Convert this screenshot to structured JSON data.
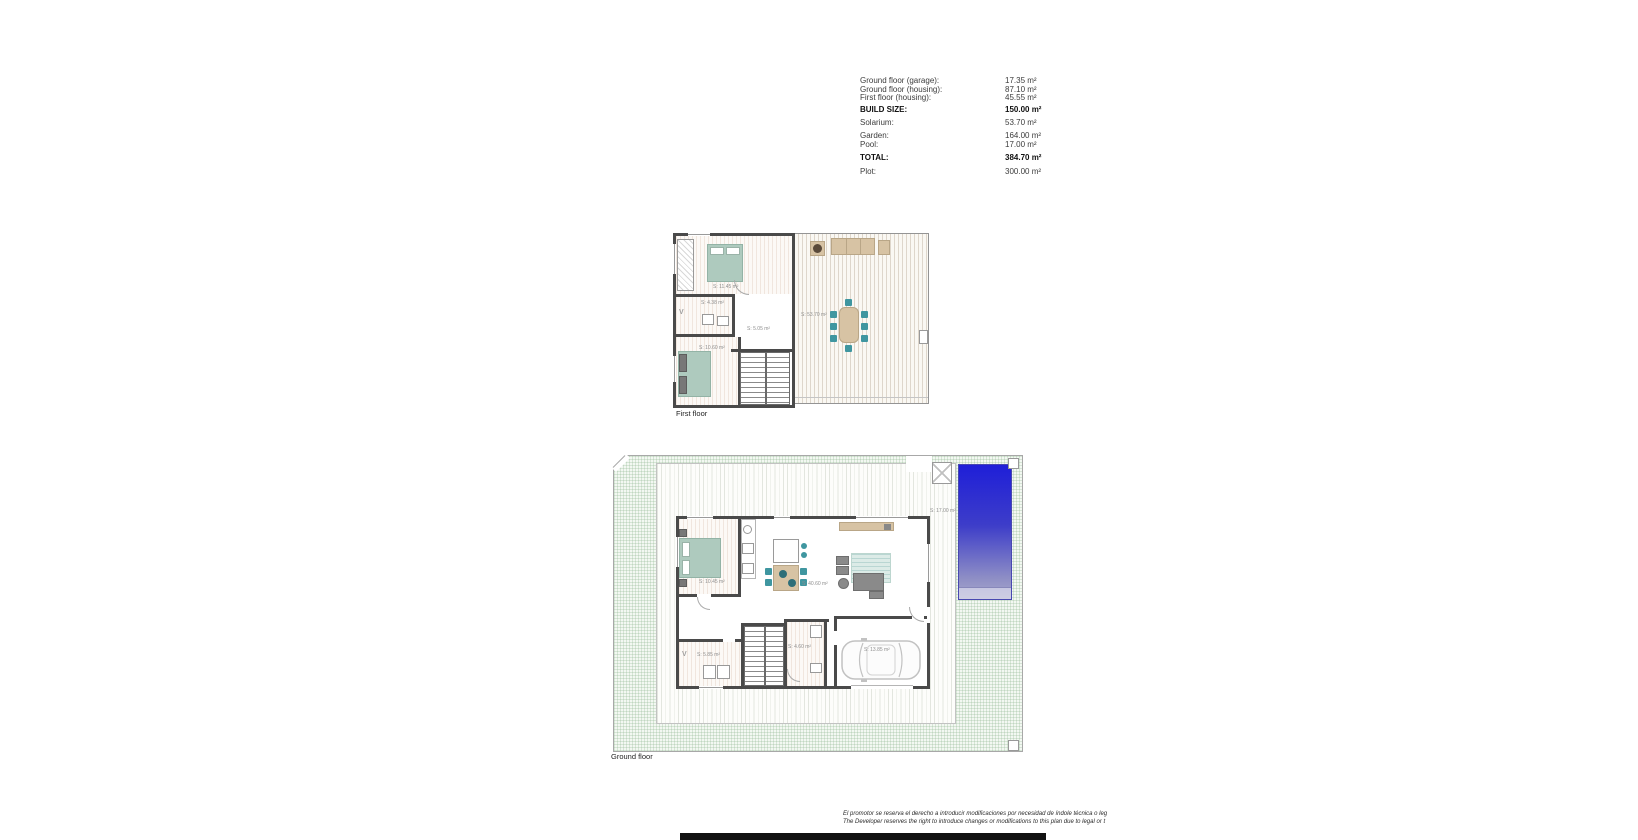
{
  "area_table": {
    "rows": [
      {
        "label": "Ground floor (garage):",
        "value": "17.35 m²"
      },
      {
        "label": "Ground floor (housing):",
        "value": "87.10 m²"
      },
      {
        "label": "First floor (housing):",
        "value": "45.55 m²"
      },
      {
        "label": "BUILD SIZE:",
        "value": "150.00 m²"
      },
      {
        "label": "Solarium:",
        "value": "53.70 m²"
      },
      {
        "label": "Garden:",
        "value": "164.00 m²"
      },
      {
        "label": "Pool:",
        "value": "17.00 m²"
      },
      {
        "label": "TOTAL:",
        "value": "384.70 m²"
      },
      {
        "label": "Plot:",
        "value": "300.00 m²"
      }
    ]
  },
  "first_floor": {
    "caption": "First floor",
    "labels": {
      "bedroom_1": "S: 11.45 m²",
      "bathroom": "S: 4.38 m²",
      "hall": "S: 5.05 m²",
      "bedroom_2": "S: 10.60 m²",
      "solarium": "S: 53.70 m²"
    }
  },
  "ground_floor": {
    "caption": "Ground floor",
    "labels": {
      "bedroom": "S: 10.45 m²",
      "living_kitchen": "S: 40.60 m²",
      "bathroom": "S: 4.60 m²",
      "laundry": "S: 5.85 m²",
      "garage": "S: 13.85 m²",
      "pool": "S: 17.00 m²"
    }
  },
  "symbols": {
    "vent": "V"
  },
  "disclaimer": {
    "line_es": "El promotor se reserva el derecho a introducir modificaciones por necesidad de índole técnica o leg",
    "line_en": "The Developer reserves the right to introduce changes or modifications to this plan due to legal or t"
  }
}
